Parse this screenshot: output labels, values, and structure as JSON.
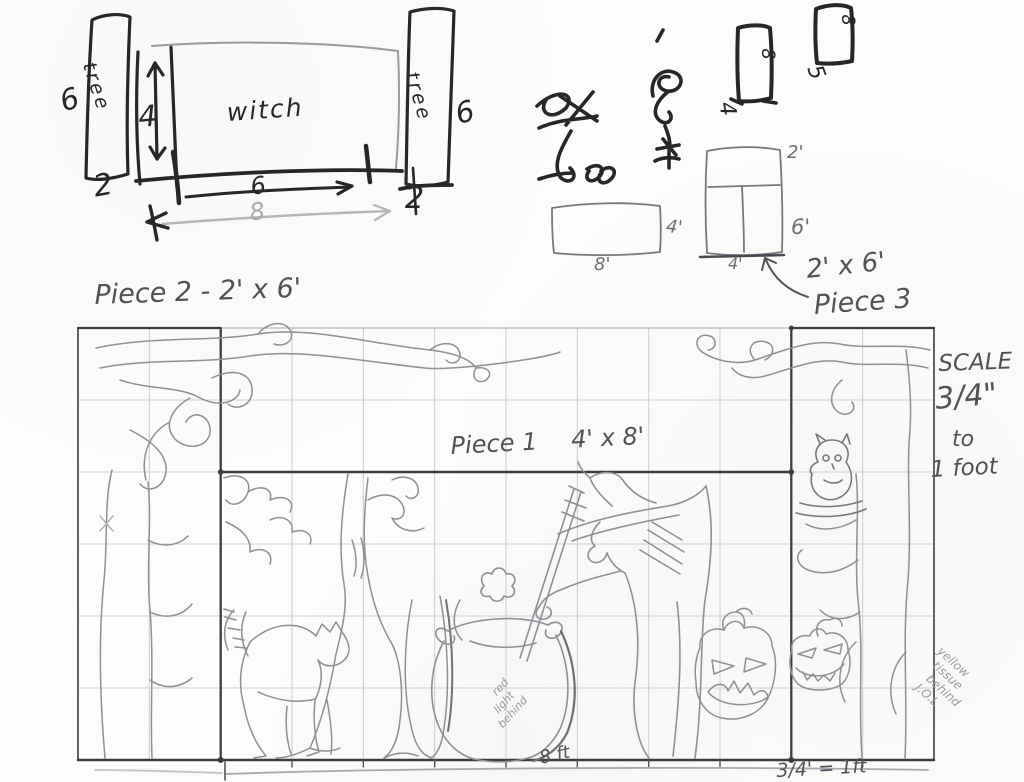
{
  "colors": {
    "paper": "#fcfcfa",
    "ink": "#26262b",
    "pencil_dark": "#515158",
    "pencil_mid": "#8f8f97",
    "pencil_light": "#b4b4bb",
    "grid_line": "#cdd0d4",
    "piece_border": "#3c3c42"
  },
  "top_left_sketch": {
    "left_tree_label": "tree",
    "right_tree_label": "tree",
    "backdrop_label": "witch",
    "left_panel_height": "6",
    "column_height": "4",
    "left_panel_width": "2",
    "span_top": "6",
    "span_bottom": "8",
    "right_panel_width": "2",
    "right_panel_height": "6"
  },
  "top_right_sketches": {
    "scribbles": [
      {
        "name": "ink-scribble-1",
        "approx_text": "4 x 8"
      },
      {
        "name": "ink-scribble-2",
        "approx_text": "2 - 4 x 4"
      }
    ],
    "small_rect_1": {
      "side_label": "8",
      "bottom_label": "4"
    },
    "small_rect_2": {
      "side_label": "8",
      "bottom_label": "5"
    },
    "wide_rect": {
      "side_label": "4'",
      "bottom_label": "8'"
    },
    "tall_rect": {
      "top_label": "2'",
      "side_label": "6'",
      "bottom_label": "4'"
    },
    "callout_dim": "2' x 6'",
    "callout_name": "Piece 3"
  },
  "plan": {
    "piece2_title": "Piece 2 - 2' x 6'",
    "piece1_name": "Piece 1",
    "piece1_dim": "4' x 8'",
    "scale_note": {
      "line1": "SCALE",
      "line2": "3/4\"",
      "line3": "to",
      "line4": "1 foot"
    },
    "cauldron_note": {
      "line1": "red",
      "line2": "light",
      "line3": "behind"
    },
    "corner_note": {
      "line1": "yellow",
      "line2": "tissue",
      "line3": "behind",
      "line4": "J.O.L"
    },
    "width_label": "8 ft",
    "scale_label": "3/4' = 1ft",
    "grid": {
      "columns": 12,
      "rows": 6
    },
    "figures": [
      "gnarled-tree-left",
      "gnarled-tree-right",
      "owl",
      "witch",
      "broomstick",
      "cauldron",
      "cat",
      "jack-o-lantern-frowning",
      "jack-o-lantern-grinning"
    ]
  }
}
